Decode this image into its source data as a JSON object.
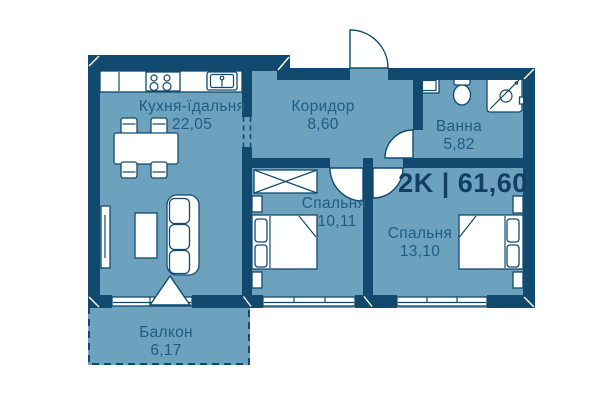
{
  "plan": {
    "summary": {
      "type": "2K",
      "area_total": "61,60",
      "label": "2K | 61,60"
    },
    "rooms": [
      {
        "id": "kitchen-dining",
        "name": "Кухня-їдальня",
        "area": "22,05"
      },
      {
        "id": "corridor",
        "name": "Коридор",
        "area": "8,60"
      },
      {
        "id": "bathroom",
        "name": "Ванна",
        "area": "5,82"
      },
      {
        "id": "bedroom-1",
        "name": "Спальня",
        "area": "10,11"
      },
      {
        "id": "bedroom-2",
        "name": "Спальня",
        "area": "13,10"
      },
      {
        "id": "balcony",
        "name": "Балкон",
        "area": "6,17"
      }
    ],
    "colors": {
      "floor": "#6DA2BF",
      "wall": "#114A6E",
      "label": "#1E5C83",
      "title": "#123E63",
      "fixture": "#FFFFFF"
    }
  }
}
